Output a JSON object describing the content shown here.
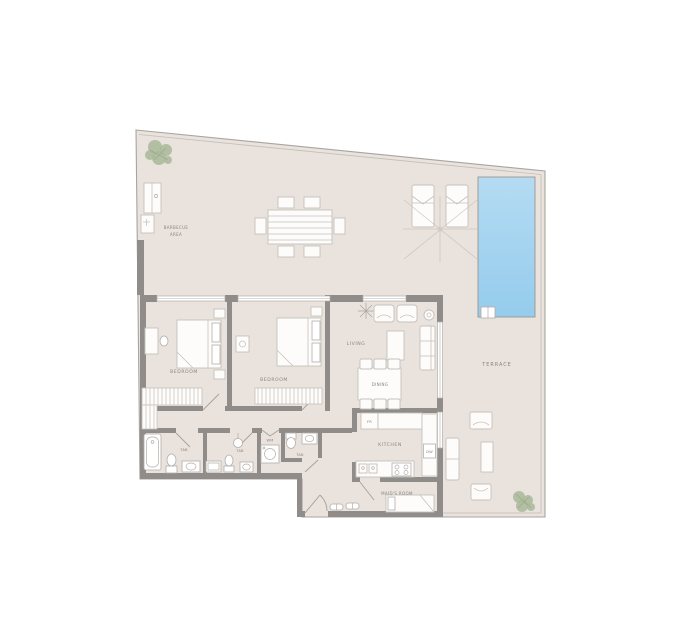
{
  "colors": {
    "floor": "#e9e2dd",
    "wall": "#8f8c89",
    "boundary": "#a8a4a0",
    "boundary_light": "#c2beba",
    "furn_fill": "#fdfcfb",
    "furn_stroke": "#c6c1bc",
    "fixture_stroke": "#b3aea9",
    "window_line": "#b3afab",
    "door": "#a5a09b",
    "label": "#8b857f",
    "pool_top": "#b4dbf3",
    "pool_bottom": "#95ccec",
    "plant": "#a9b999",
    "plant_dark": "#8fa37e"
  },
  "rooms": {
    "barbecue_line1": "BARBECUE",
    "barbecue_line2": "AREA",
    "terrace": "TERRACE",
    "living": "LIVING",
    "dining": "DINING",
    "bedroom_1": "BEDROOM",
    "bedroom_2": "BEDROOM",
    "kitchen": "KITCHEN",
    "maids_room": "MAID'S ROOM",
    "bath_1": "TAB",
    "bath_2": "TAB",
    "bath_3": "TAB"
  },
  "appliances": {
    "fridge": "FR",
    "dishwasher": "DW",
    "washing_machine": "WM"
  }
}
